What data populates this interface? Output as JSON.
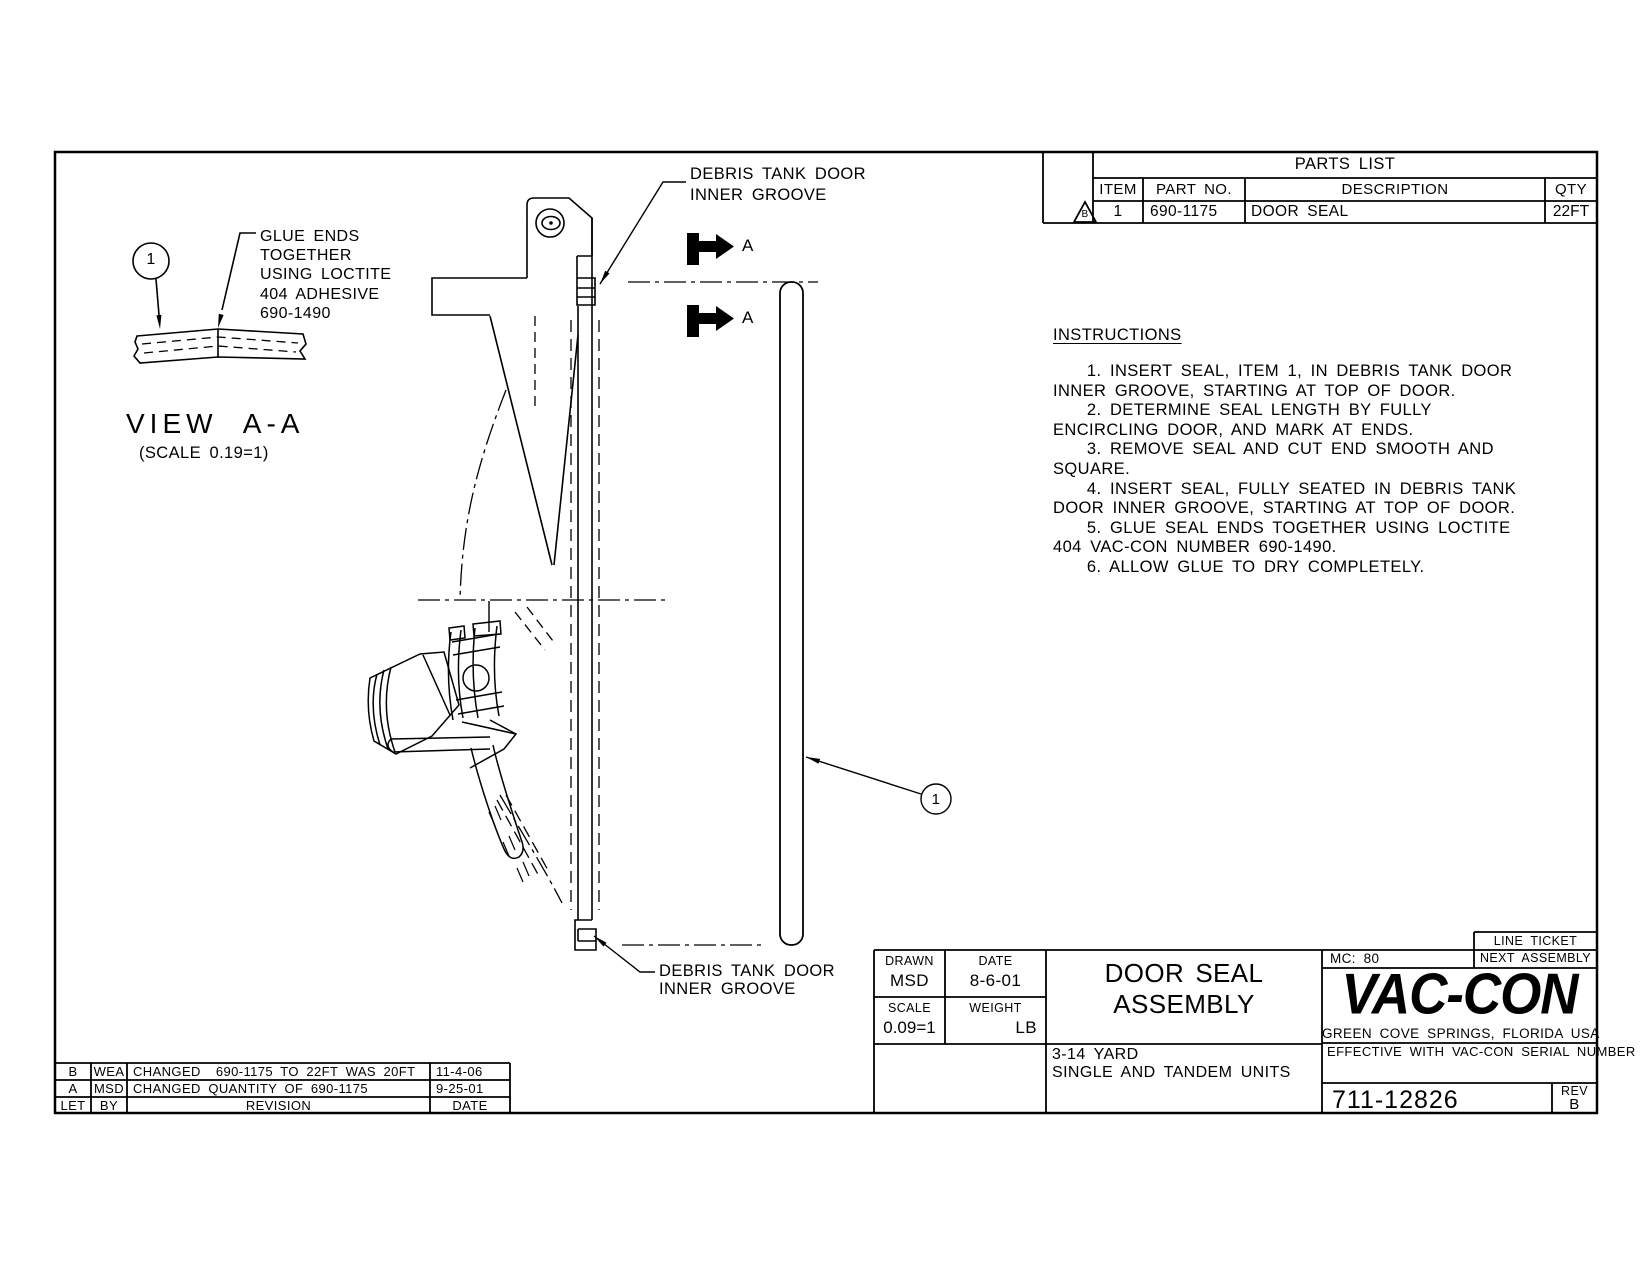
{
  "colors": {
    "line": "#000000",
    "paper": "#ffffff"
  },
  "parts_list": {
    "title": "PARTS LIST",
    "flag": "B",
    "headers": {
      "item": "ITEM",
      "part_no": "PART NO.",
      "description": "DESCRIPTION",
      "qty": "QTY"
    },
    "rows": [
      {
        "item": "1",
        "part_no": "690-1175",
        "description": "DOOR SEAL",
        "qty": "22FT"
      }
    ]
  },
  "instructions": {
    "title": "INSTRUCTIONS",
    "body": "    1. INSERT SEAL, ITEM 1, IN DEBRIS TANK DOOR\nINNER GROOVE, STARTING AT TOP OF DOOR.\n    2. DETERMINE SEAL LENGTH BY FULLY\nENCIRCLING DOOR, AND MARK AT ENDS.\n    3. REMOVE SEAL AND CUT END SMOOTH AND\nSQUARE.\n    4. INSERT SEAL, FULLY SEATED IN DEBRIS TANK\nDOOR INNER GROOVE, STARTING AT TOP OF DOOR.\n    5. GLUE SEAL ENDS TOGETHER USING LOCTITE\n404 VAC-CON NUMBER 690-1490.\n    6. ALLOW GLUE TO DRY COMPLETELY."
  },
  "view_a": {
    "balloon": "1",
    "glue_note": "GLUE ENDS\nTOGETHER\nUSING LOCTITE\n404 ADHESIVE\n690-1490",
    "title": "VIEW A-A",
    "scale_note": "(SCALE 0.19=1)"
  },
  "main_view": {
    "top_label": "DEBRIS TANK DOOR\nINNER GROOVE",
    "bottom_label": "DEBRIS TANK DOOR\nINNER GROOVE",
    "section_a_top": "A",
    "section_a_bottom": "A",
    "seal_balloon": "1"
  },
  "title_block": {
    "drawn_label": "DRAWN",
    "drawn": "MSD",
    "date_label": "DATE",
    "date": "8-6-01",
    "scale_label": "SCALE",
    "scale": "0.09=1",
    "weight_label": "WEIGHT",
    "weight": "LB",
    "title": "DOOR SEAL\nASSEMBLY",
    "units": "3-14 YARD\nSINGLE AND TANDEM UNITS",
    "mc": "MC: 80",
    "line_ticket": "LINE TICKET",
    "next_assembly": "NEXT ASSEMBLY",
    "logo": "VAC-CON",
    "logo_sub": "GREEN COVE SPRINGS, FLORIDA USA",
    "effective": "EFFECTIVE WITH VAC-CON SERIAL NUMBER",
    "drawing_number": "711-12826",
    "rev_label": "REV",
    "rev": "B"
  },
  "revision_table": {
    "rows": [
      {
        "let": "B",
        "by": "WEA",
        "revision": "CHANGED  690-1175 TO 22FT WAS 20FT",
        "date": "11-4-06"
      },
      {
        "let": "A",
        "by": "MSD",
        "revision": "CHANGED QUANTITY OF 690-1175",
        "date": "9-25-01"
      },
      {
        "let": "LET",
        "by": "BY",
        "revision": "REVISION",
        "date": "DATE"
      }
    ]
  }
}
